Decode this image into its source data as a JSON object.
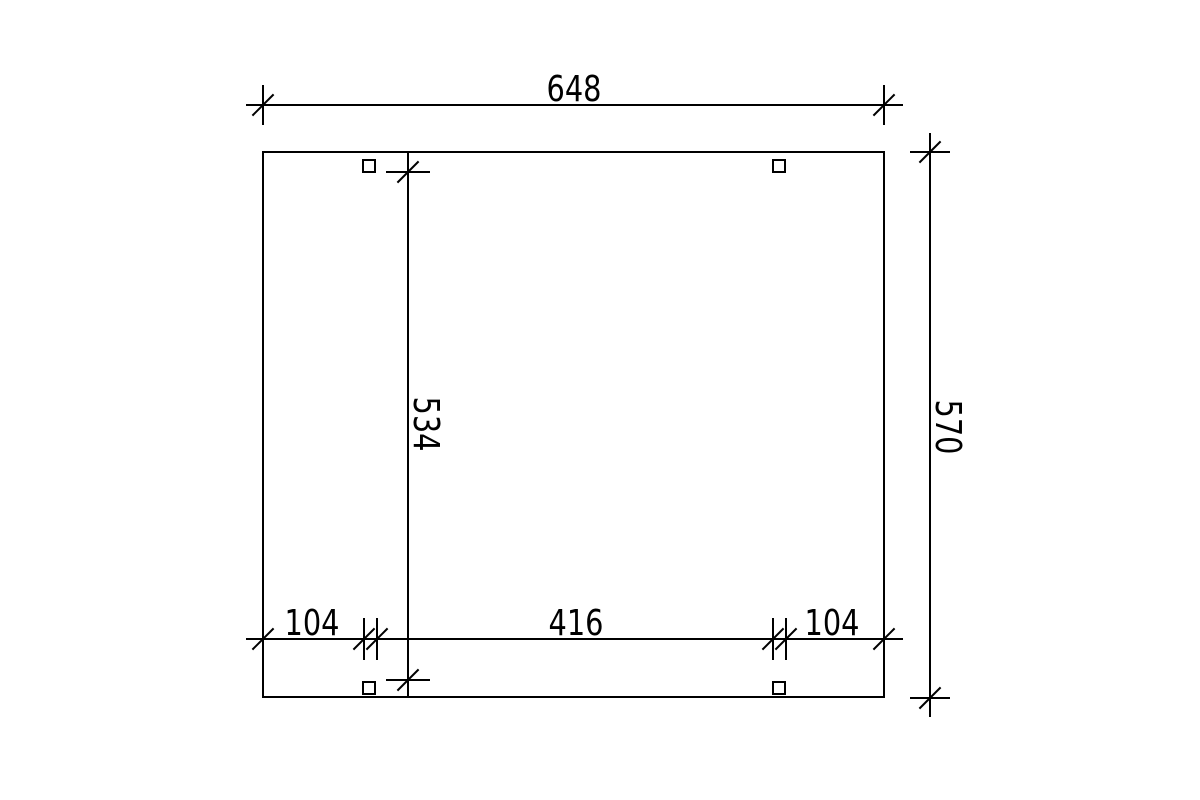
{
  "drawing": {
    "background_color": "#ffffff",
    "line_color": "#000000",
    "structure": {
      "shape": "rectangle-plan",
      "post_count": 4
    },
    "dimensions": {
      "top": {
        "label": "648",
        "value": 648
      },
      "right": {
        "label": "570",
        "value": 570
      },
      "inner": {
        "label": "534",
        "value": 534
      },
      "bottom_left": {
        "label": "104",
        "value": 104
      },
      "bottom_center": {
        "label": "416",
        "value": 416
      },
      "bottom_right": {
        "label": "104",
        "value": 104
      }
    }
  }
}
